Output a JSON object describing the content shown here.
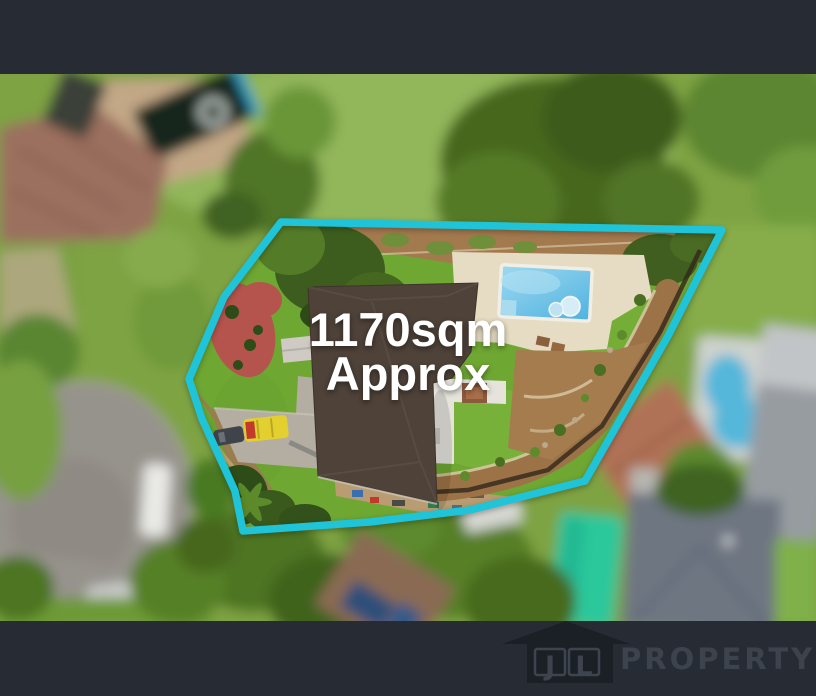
{
  "overlay": {
    "area_line1": "1170sqm",
    "area_line2": "Approx"
  },
  "branding": {
    "initial_left": "J",
    "initial_right": "L",
    "name": "PROPERTY"
  },
  "palette": {
    "boundary": "#1fc4d8",
    "bar": "#272c34",
    "overlay_text": "#ffffff",
    "lawn": "#6fa733",
    "blurred_lawn": "#7ea342",
    "pool": "#5fc0e8",
    "neighbor_pool": "#55b7da",
    "roof": "#4e4239",
    "paving": "#e6dcc3",
    "dirt": "#9c7347",
    "road": "#96938c",
    "mulch": "#b5544c",
    "teal_feature": "#2bc89b",
    "terracotta_roof": "#b07257",
    "slate_roof": "#6e7682",
    "vehicle_yellow": "#e3cf2e",
    "logo_house": "#1a2026",
    "logo_text": "#3c434d"
  }
}
